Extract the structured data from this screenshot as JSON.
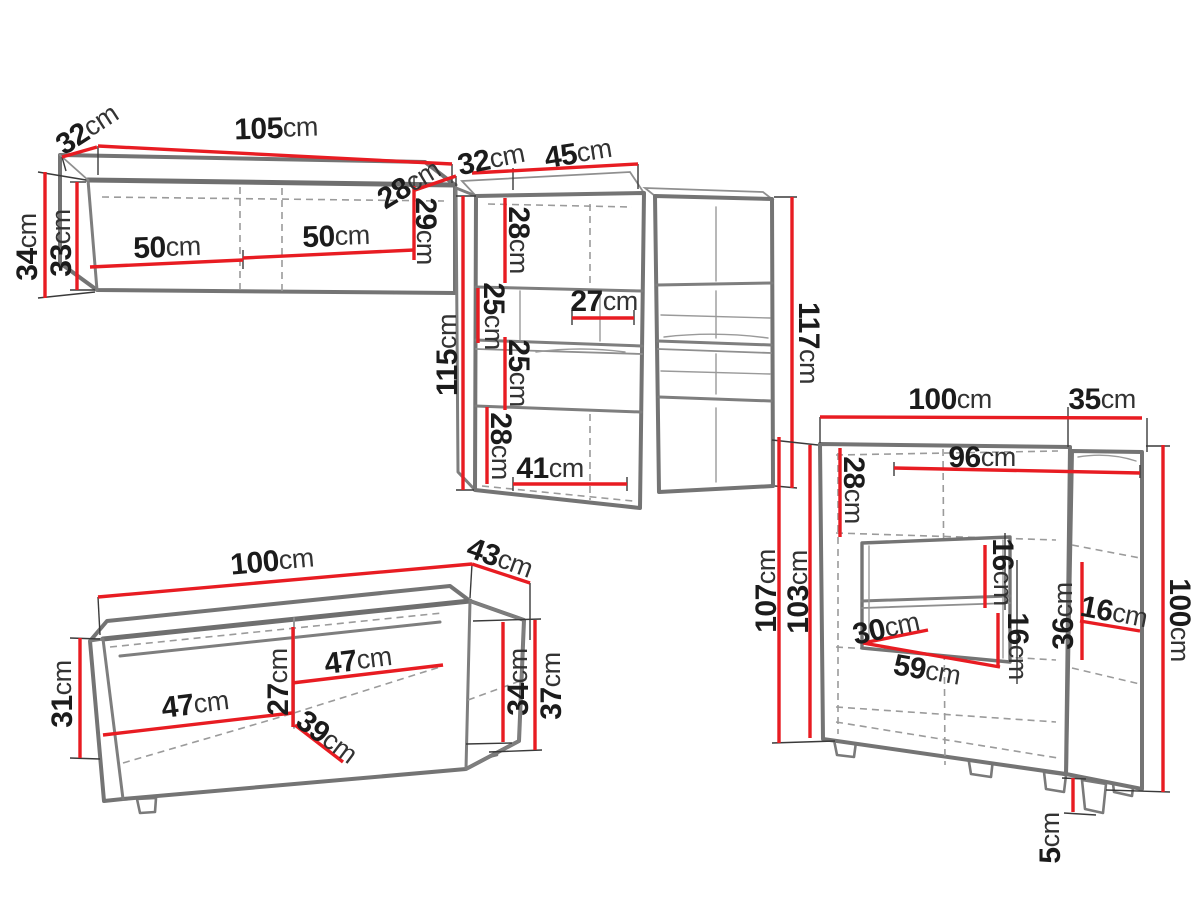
{
  "unit": "cm",
  "colors": {
    "dimension_line": "#e81c22",
    "furniture_outline": "#747474",
    "hidden_line": "#9b9b9b",
    "label_number": "#1b1b1b",
    "label_unit": "#333333",
    "background": "#ffffff"
  },
  "pieces": {
    "wall_shelf": {
      "title": "hanging wall shelf",
      "dims": {
        "depth": "32",
        "width": "105",
        "height": "34",
        "height_inner": "33",
        "door_left": "50",
        "door_right": "50",
        "depth_inner": "28",
        "height_right": "29"
      }
    },
    "cabinet_left": {
      "title": "hanging cabinet (left)",
      "dims": {
        "depth": "32",
        "width": "45",
        "height": "115",
        "section_top": "28",
        "section_upper_mid": "25",
        "section_lower_mid": "25",
        "section_bottom": "28",
        "inner_width": "27",
        "bottom_width": "41"
      }
    },
    "cabinet_right": {
      "title": "hanging cabinet (right)",
      "dims": {
        "height": "117"
      }
    },
    "tv_stand": {
      "title": "TV stand",
      "dims": {
        "width": "100",
        "depth": "43",
        "height_left": "31",
        "door_left": "47",
        "inner_height": "27",
        "door_right": "47",
        "inner_depth": "39",
        "inner_height_right": "34",
        "height_right": "37"
      }
    },
    "sideboard": {
      "title": "highboard / sideboard",
      "dims": {
        "width": "100",
        "depth": "35",
        "inner_width": "96",
        "section_top": "28",
        "height": "107",
        "height_inner": "103",
        "niche_shelf_upper": "16",
        "niche_shelf_lower": "16",
        "niche_height": "36",
        "side_shelf": "16",
        "niche_width_top": "30",
        "niche_width_bottom": "59",
        "height_right": "100",
        "feet": "5"
      }
    }
  }
}
